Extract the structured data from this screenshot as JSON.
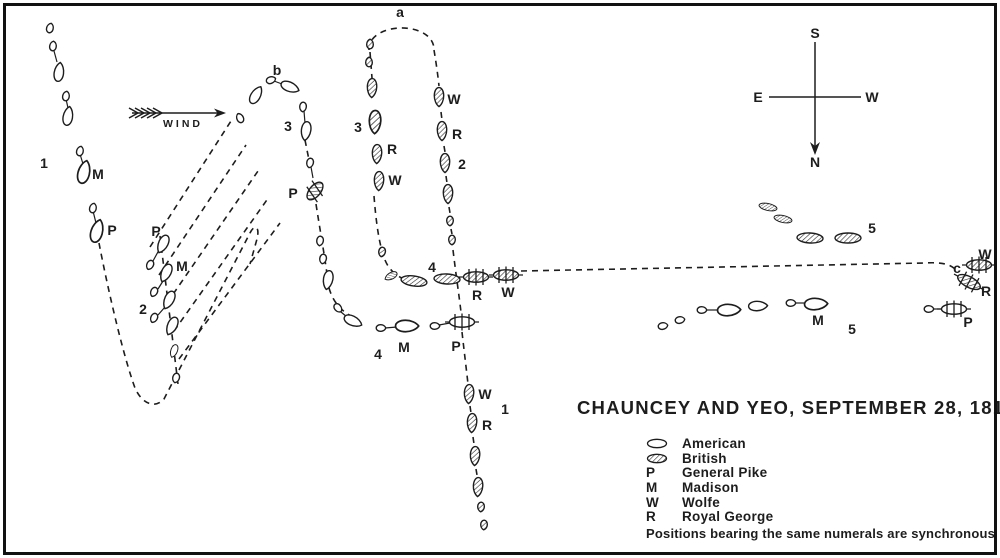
{
  "title": "CHAUNCEY AND YEO, SEPTEMBER 28, 1813",
  "colors": {
    "ink": "#1d1d1d",
    "paper": "#ffffff"
  },
  "compass": {
    "top": "S",
    "bottom": "N",
    "left": "E",
    "right": "W"
  },
  "wind": {
    "label": "WIND"
  },
  "legend": {
    "items": [
      {
        "key": "",
        "symbol": "american-hull-icon",
        "label": "American"
      },
      {
        "key": "",
        "symbol": "british-hull-icon",
        "label": "British"
      },
      {
        "key": "P",
        "label": "General Pike"
      },
      {
        "key": "M",
        "label": "Madison"
      },
      {
        "key": "W",
        "label": "Wolfe"
      },
      {
        "key": "R",
        "label": "Royal George"
      }
    ],
    "note": "Positions bearing the same numerals are synchronous"
  },
  "map_labels": [
    {
      "t": "a",
      "x": 400,
      "y": 12
    },
    {
      "t": "b",
      "x": 277,
      "y": 70
    },
    {
      "t": "c",
      "x": 957,
      "y": 268
    },
    {
      "t": "1",
      "x": 44,
      "y": 163
    },
    {
      "t": "M",
      "x": 98,
      "y": 174
    },
    {
      "t": "P",
      "x": 112,
      "y": 230
    },
    {
      "t": "P",
      "x": 156,
      "y": 231
    },
    {
      "t": "M",
      "x": 182,
      "y": 266
    },
    {
      "t": "2",
      "x": 143,
      "y": 309
    },
    {
      "t": "3",
      "x": 288,
      "y": 126
    },
    {
      "t": "P",
      "x": 293,
      "y": 193
    },
    {
      "t": "3",
      "x": 358,
      "y": 127
    },
    {
      "t": "R",
      "x": 392,
      "y": 149
    },
    {
      "t": "W",
      "x": 395,
      "y": 180
    },
    {
      "t": "W",
      "x": 454,
      "y": 99
    },
    {
      "t": "R",
      "x": 457,
      "y": 134
    },
    {
      "t": "2",
      "x": 462,
      "y": 164
    },
    {
      "t": "4",
      "x": 432,
      "y": 267
    },
    {
      "t": "R",
      "x": 477,
      "y": 295
    },
    {
      "t": "W",
      "x": 508,
      "y": 292
    },
    {
      "t": "4",
      "x": 378,
      "y": 354
    },
    {
      "t": "M",
      "x": 404,
      "y": 347
    },
    {
      "t": "P",
      "x": 456,
      "y": 346
    },
    {
      "t": "W",
      "x": 485,
      "y": 394
    },
    {
      "t": "1",
      "x": 505,
      "y": 409
    },
    {
      "t": "R",
      "x": 487,
      "y": 425
    },
    {
      "t": "5",
      "x": 872,
      "y": 228
    },
    {
      "t": "M",
      "x": 818,
      "y": 320
    },
    {
      "t": "5",
      "x": 852,
      "y": 329
    },
    {
      "t": "W",
      "x": 985,
      "y": 254
    },
    {
      "t": "R",
      "x": 986,
      "y": 291
    },
    {
      "t": "P",
      "x": 968,
      "y": 322
    }
  ],
  "ships": [
    {
      "k": "boat",
      "n": "A",
      "x": 50,
      "y": 28,
      "r": 15
    },
    {
      "k": "boat",
      "n": "A",
      "x": 53,
      "y": 46,
      "r": 8
    },
    {
      "k": "hull",
      "n": "A",
      "x": 59,
      "y": 72,
      "r": 8,
      "s": "m"
    },
    {
      "k": "boat",
      "n": "A",
      "x": 66,
      "y": 96,
      "r": 10
    },
    {
      "k": "hull",
      "n": "A",
      "x": 68,
      "y": 116,
      "r": 10,
      "s": "m"
    },
    {
      "k": "boat",
      "n": "A",
      "x": 80,
      "y": 151,
      "r": 14
    },
    {
      "k": "hull",
      "n": "A",
      "x": 84,
      "y": 172,
      "r": 14,
      "s": "l"
    },
    {
      "k": "boat",
      "n": "A",
      "x": 93,
      "y": 208,
      "r": 14
    },
    {
      "k": "hull",
      "n": "A",
      "x": 97,
      "y": 231,
      "r": 16,
      "s": "l"
    },
    {
      "k": "hull",
      "n": "A",
      "x": 163,
      "y": 244,
      "r": 205,
      "s": "m"
    },
    {
      "k": "boat",
      "n": "A",
      "x": 150,
      "y": 265,
      "r": 205
    },
    {
      "k": "hull",
      "n": "A",
      "x": 166,
      "y": 273,
      "r": 205,
      "s": "m"
    },
    {
      "k": "boat",
      "n": "A",
      "x": 154,
      "y": 292,
      "r": 205
    },
    {
      "k": "hull",
      "n": "A",
      "x": 169,
      "y": 300,
      "r": 205,
      "s": "m"
    },
    {
      "k": "boat",
      "n": "A",
      "x": 154,
      "y": 318,
      "r": 205
    },
    {
      "k": "hull",
      "n": "A",
      "x": 172,
      "y": 326,
      "r": 205,
      "s": "m"
    },
    {
      "k": "hull",
      "n": "A",
      "x": 174,
      "y": 351,
      "r": 200,
      "s": "s"
    },
    {
      "k": "boat",
      "n": "A",
      "x": 176,
      "y": 378,
      "r": 195
    },
    {
      "k": "boat",
      "n": "A",
      "x": 240,
      "y": 118,
      "r": -25
    },
    {
      "k": "hull",
      "n": "A",
      "x": 256,
      "y": 95,
      "r": 30,
      "s": "m"
    },
    {
      "k": "boat",
      "n": "A",
      "x": 271,
      "y": 80,
      "r": 70
    },
    {
      "k": "hull",
      "n": "A",
      "x": 290,
      "y": 87,
      "r": 112,
      "s": "m"
    },
    {
      "k": "boat",
      "n": "A",
      "x": 303,
      "y": 107,
      "r": 185
    },
    {
      "k": "hull",
      "n": "A",
      "x": 306,
      "y": 131,
      "r": 188,
      "s": "m"
    },
    {
      "k": "boat",
      "n": "A",
      "x": 310,
      "y": 163,
      "r": 192
    },
    {
      "k": "damaged",
      "n": "B",
      "x": 315,
      "y": 191,
      "r": 40
    },
    {
      "k": "boat",
      "n": "A",
      "x": 320,
      "y": 241,
      "r": 188
    },
    {
      "k": "boat",
      "n": "A",
      "x": 323,
      "y": 259,
      "r": 190
    },
    {
      "k": "hull",
      "n": "A",
      "x": 328,
      "y": 280,
      "r": 190,
      "s": "m"
    },
    {
      "k": "boat",
      "n": "A",
      "x": 338,
      "y": 308,
      "r": 140
    },
    {
      "k": "hull",
      "n": "A",
      "x": 353,
      "y": 321,
      "r": 115,
      "s": "m"
    },
    {
      "k": "boat",
      "n": "A",
      "x": 381,
      "y": 328,
      "r": 90
    },
    {
      "k": "hull",
      "n": "A",
      "x": 407,
      "y": 326,
      "r": 90,
      "s": "l"
    },
    {
      "k": "boat",
      "n": "A",
      "x": 435,
      "y": 326,
      "r": 90
    },
    {
      "k": "masted",
      "n": "A",
      "x": 462,
      "y": 322,
      "r": 0
    },
    {
      "k": "boat",
      "n": "A",
      "x": 663,
      "y": 326,
      "r": 80
    },
    {
      "k": "boat",
      "n": "A",
      "x": 680,
      "y": 320,
      "r": 80
    },
    {
      "k": "boat",
      "n": "A",
      "x": 702,
      "y": 310,
      "r": 90
    },
    {
      "k": "hull",
      "n": "A",
      "x": 729,
      "y": 310,
      "r": 88,
      "s": "l"
    },
    {
      "k": "hull",
      "n": "A",
      "x": 758,
      "y": 306,
      "r": 88,
      "s": "m"
    },
    {
      "k": "boat",
      "n": "A",
      "x": 791,
      "y": 303,
      "r": 90
    },
    {
      "k": "hull",
      "n": "A",
      "x": 816,
      "y": 304,
      "r": 88,
      "s": "l"
    },
    {
      "k": "boat",
      "n": "A",
      "x": 929,
      "y": 309,
      "r": 90
    },
    {
      "k": "masted",
      "n": "A",
      "x": 954,
      "y": 309,
      "r": 0
    },
    {
      "k": "boat",
      "n": "B",
      "x": 370,
      "y": 44,
      "r": 0
    },
    {
      "k": "boat",
      "n": "B",
      "x": 369,
      "y": 62,
      "r": 0
    },
    {
      "k": "hull",
      "n": "B",
      "x": 372,
      "y": 88,
      "r": 182,
      "s": "m"
    },
    {
      "k": "hull",
      "n": "B",
      "x": 375,
      "y": 122,
      "r": 182,
      "s": "l"
    },
    {
      "k": "hull",
      "n": "B",
      "x": 377,
      "y": 154,
      "r": 182,
      "s": "m"
    },
    {
      "k": "hull",
      "n": "B",
      "x": 379,
      "y": 181,
      "r": 182,
      "s": "m"
    },
    {
      "k": "boat",
      "n": "B",
      "x": 382,
      "y": 252,
      "r": 190
    },
    {
      "k": "hull",
      "n": "B",
      "x": 391,
      "y": 276,
      "r": 242,
      "s": "s"
    },
    {
      "k": "ell",
      "n": "B",
      "x": 414,
      "y": 281,
      "r": 8,
      "s": "m"
    },
    {
      "k": "ell",
      "n": "B",
      "x": 447,
      "y": 279,
      "r": 3,
      "s": "m"
    },
    {
      "k": "masted",
      "n": "B",
      "x": 476,
      "y": 277,
      "r": 0
    },
    {
      "k": "masted",
      "n": "B",
      "x": 506,
      "y": 275,
      "r": 0
    },
    {
      "k": "hull",
      "n": "B",
      "x": 439,
      "y": 97,
      "r": 180,
      "s": "m"
    },
    {
      "k": "hull",
      "n": "B",
      "x": 442,
      "y": 131,
      "r": 180,
      "s": "m"
    },
    {
      "k": "hull",
      "n": "B",
      "x": 445,
      "y": 163,
      "r": 180,
      "s": "m"
    },
    {
      "k": "hull",
      "n": "B",
      "x": 448,
      "y": 194,
      "r": 180,
      "s": "m"
    },
    {
      "k": "boat",
      "n": "B",
      "x": 450,
      "y": 221,
      "r": 180
    },
    {
      "k": "boat",
      "n": "B",
      "x": 452,
      "y": 240,
      "r": 180
    },
    {
      "k": "hull",
      "n": "B",
      "x": 469,
      "y": 394,
      "r": 183,
      "s": "m"
    },
    {
      "k": "hull",
      "n": "B",
      "x": 472,
      "y": 423,
      "r": 183,
      "s": "m"
    },
    {
      "k": "hull",
      "n": "B",
      "x": 475,
      "y": 456,
      "r": 183,
      "s": "m"
    },
    {
      "k": "hull",
      "n": "B",
      "x": 478,
      "y": 487,
      "r": 183,
      "s": "m"
    },
    {
      "k": "boat",
      "n": "B",
      "x": 481,
      "y": 507,
      "r": 183
    },
    {
      "k": "boat",
      "n": "B",
      "x": 484,
      "y": 525,
      "r": 183
    },
    {
      "k": "ell",
      "n": "B",
      "x": 768,
      "y": 207,
      "r": 12,
      "s": "s"
    },
    {
      "k": "ell",
      "n": "B",
      "x": 783,
      "y": 219,
      "r": 12,
      "s": "s"
    },
    {
      "k": "ell",
      "n": "B",
      "x": 810,
      "y": 238,
      "r": 3,
      "s": "m"
    },
    {
      "k": "ell",
      "n": "B",
      "x": 848,
      "y": 238,
      "r": 0,
      "s": "m"
    },
    {
      "k": "masted",
      "n": "B",
      "x": 979,
      "y": 265,
      "r": 0
    },
    {
      "k": "masted",
      "n": "B",
      "x": 969,
      "y": 282,
      "r": 28
    }
  ]
}
